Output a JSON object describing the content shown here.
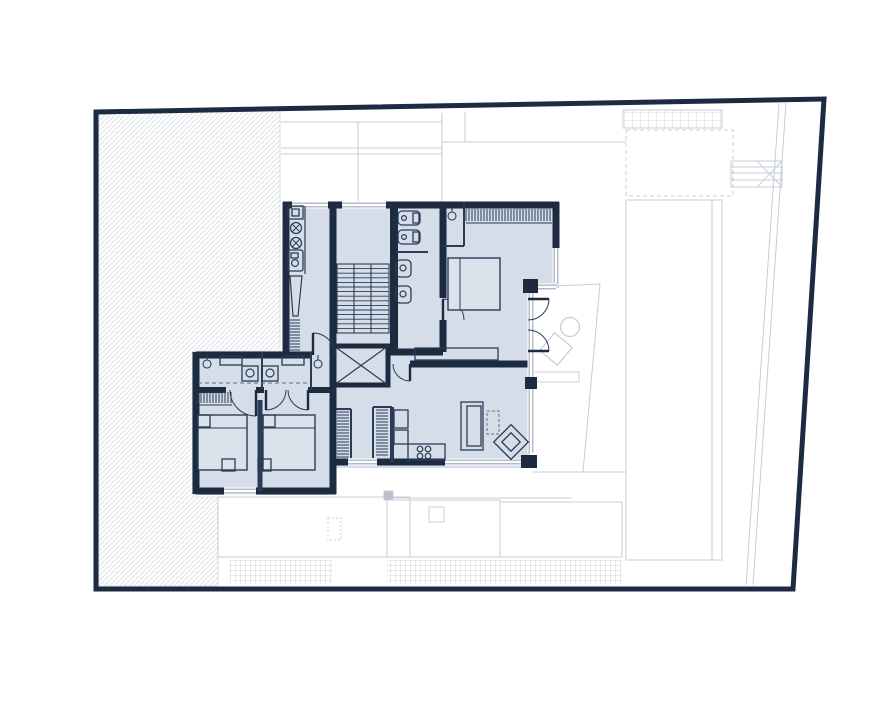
{
  "meta": {
    "description": "architectural-floor-plan",
    "canvas": {
      "width": 891,
      "height": 713,
      "background": "#ffffff"
    }
  },
  "colors": {
    "navy": "#1c2b40",
    "room_fill": "#d5dee8",
    "bed_fill": "#dae2eb",
    "thin": "#2b3b57",
    "window": "#9aa6b6",
    "site": "#c7ccd5",
    "hatch": "#dcdfe4",
    "dash": "#5f6e84",
    "white": "#ffffff",
    "post": "#b9c0cb"
  },
  "boundary": {
    "points": [
      [
        96,
        112
      ],
      [
        824,
        99
      ],
      [
        793,
        589
      ],
      [
        96,
        589
      ]
    ],
    "stroke_width": 5
  },
  "hatch_area": {
    "points": [
      [
        99,
        114
      ],
      [
        280,
        109
      ],
      [
        280,
        351
      ],
      [
        196,
        351
      ],
      [
        196,
        497
      ],
      [
        218,
        497
      ],
      [
        218,
        586
      ],
      [
        99,
        586
      ]
    ],
    "line_spacing": 5
  },
  "site": {
    "lines": [
      [
        281,
        122,
        442,
        122
      ],
      [
        281,
        148,
        442,
        148
      ],
      [
        281,
        154,
        442,
        154
      ],
      [
        358,
        122,
        358,
        202
      ],
      [
        442,
        113,
        442,
        202
      ],
      [
        465,
        112,
        465,
        142
      ],
      [
        442,
        142,
        626,
        142
      ],
      [
        533,
        287,
        600,
        284
      ],
      [
        600,
        284,
        583,
        472
      ],
      [
        533,
        472,
        626,
        472
      ],
      [
        387,
        498,
        572,
        498
      ],
      [
        410,
        497,
        410,
        557
      ],
      [
        712,
        200,
        712,
        560
      ],
      [
        731,
        167,
        782,
        167
      ],
      [
        731,
        173,
        782,
        173
      ],
      [
        731,
        180,
        782,
        180
      ],
      [
        757,
        161,
        782,
        187
      ],
      [
        757,
        187,
        782,
        161
      ],
      [
        779,
        103,
        746,
        585
      ],
      [
        786,
        103,
        753,
        585
      ]
    ],
    "rects": [
      {
        "name": "terrace-south-west",
        "x": 218,
        "y": 497,
        "w": 192,
        "h": 60
      },
      {
        "name": "terrace-south-mid",
        "x": 387,
        "y": 500,
        "w": 113,
        "h": 57
      },
      {
        "name": "terrace-skylight",
        "x": 429,
        "y": 507,
        "w": 15,
        "h": 15
      },
      {
        "name": "terrace-south-east",
        "x": 500,
        "y": 502,
        "w": 122,
        "h": 55
      },
      {
        "name": "pool-strip",
        "x": 626,
        "y": 200,
        "w": 96,
        "h": 360
      },
      {
        "name": "roof-dashed",
        "x": 626,
        "y": 130,
        "w": 107,
        "h": 66,
        "dash": "4 3"
      },
      {
        "name": "bridge-box",
        "x": 731,
        "y": 161,
        "w": 51,
        "h": 26
      },
      {
        "name": "terrace-bench",
        "x": 534,
        "y": 372,
        "w": 45,
        "h": 10,
        "fill": "#ffffff"
      },
      {
        "name": "terrace-post",
        "x": 384,
        "y": 491,
        "w": 9,
        "h": 9,
        "fill": "#b9c0cb"
      },
      {
        "name": "chimney-dashed",
        "x": 328,
        "y": 518,
        "w": 13,
        "h": 22,
        "dash": "2 2"
      }
    ],
    "grids": [
      {
        "name": "pergola-grid",
        "x": 623,
        "y": 110,
        "w": 99,
        "h": 18,
        "step": 8,
        "border": true
      },
      {
        "name": "deck-grid-west",
        "x": 230,
        "y": 560,
        "w": 103,
        "h": 24,
        "step": 5,
        "border": false
      },
      {
        "name": "deck-grid-east",
        "x": 387,
        "y": 560,
        "w": 235,
        "h": 24,
        "step": 5,
        "border": false
      }
    ],
    "circles": [
      {
        "name": "terrace-table",
        "cx": 570,
        "cy": 327,
        "r": 9.5
      }
    ],
    "diamonds": [
      {
        "name": "terrace-chair",
        "cx": 556,
        "cy": 349,
        "r": 16
      }
    ]
  },
  "plan": {
    "silhouette": [
      [
        283,
        202
      ],
      [
        559,
        202
      ],
      [
        559,
        288
      ],
      [
        530,
        288
      ],
      [
        530,
        468
      ],
      [
        330,
        468
      ],
      [
        330,
        495
      ],
      [
        192,
        495
      ],
      [
        192,
        351
      ],
      [
        283,
        351
      ]
    ],
    "walls": [
      [
        283,
        205,
        292,
        205,
        7
      ],
      [
        328,
        205,
        342,
        205,
        7
      ],
      [
        386,
        205,
        559,
        205,
        7
      ],
      [
        286,
        202,
        286,
        352,
        7
      ],
      [
        196,
        355,
        312,
        355,
        7
      ],
      [
        196,
        352,
        196,
        494,
        7
      ],
      [
        196,
        491,
        224,
        491,
        7
      ],
      [
        256,
        491,
        336,
        491,
        7
      ],
      [
        333,
        352,
        333,
        494,
        7
      ],
      [
        333,
        462,
        348,
        462,
        7
      ],
      [
        377,
        462,
        445,
        462,
        7
      ],
      [
        410,
        364,
        531,
        364,
        7
      ],
      [
        394,
        202,
        394,
        352,
        8
      ],
      [
        443,
        202,
        443,
        298,
        7
      ],
      [
        443,
        320,
        443,
        352,
        7
      ],
      [
        333,
        202,
        333,
        352,
        7
      ],
      [
        556,
        202,
        556,
        248,
        7
      ],
      [
        390,
        352,
        443,
        352,
        7
      ],
      [
        196,
        390,
        226,
        390,
        6
      ],
      [
        256,
        390,
        264,
        390,
        6
      ],
      [
        308,
        390,
        336,
        390,
        6
      ]
    ],
    "navy_blocks": [
      {
        "name": "glass-step-corner",
        "x": 523,
        "y": 279,
        "w": 15,
        "h": 14
      },
      {
        "name": "glass-mid-pier",
        "x": 525,
        "y": 377,
        "w": 12,
        "h": 12
      },
      {
        "name": "living-south-corner",
        "x": 521,
        "y": 455,
        "w": 16,
        "h": 13
      }
    ],
    "thin_walls": [
      [
        464,
        202,
        464,
        246,
        2
      ],
      [
        443,
        246,
        464,
        246,
        2
      ],
      [
        262,
        352,
        262,
        390,
        2
      ],
      [
        311,
        352,
        311,
        390,
        2
      ],
      [
        396,
        252,
        428,
        252,
        2
      ],
      [
        351,
        409,
        351,
        458,
        2
      ],
      [
        336,
        409,
        351,
        409,
        2
      ],
      [
        373,
        407,
        373,
        458,
        2
      ],
      [
        373,
        407,
        392,
        407,
        2
      ],
      [
        392,
        407,
        392,
        462,
        4
      ],
      [
        260,
        400,
        260,
        491,
        5
      ]
    ],
    "windows": [
      [
        292,
        205,
        328,
        205
      ],
      [
        342,
        205,
        386,
        205
      ],
      [
        556,
        248,
        556,
        283
      ],
      [
        538,
        287,
        556,
        287
      ],
      [
        531,
        293,
        531,
        377
      ],
      [
        531,
        389,
        531,
        453
      ],
      [
        348,
        462,
        377,
        462
      ],
      [
        445,
        462,
        521,
        462
      ],
      [
        224,
        491,
        256,
        491
      ]
    ],
    "doors": [
      {
        "name": "hall-door",
        "cx": 313,
        "cy": 355,
        "r": 22,
        "a1": 270,
        "a2": 0
      },
      {
        "name": "living-door",
        "cx": 410,
        "cy": 364,
        "r": 17,
        "a1": 90,
        "a2": 180
      },
      {
        "name": "ensuite-door",
        "cx": 443,
        "cy": 320,
        "r": 21,
        "a1": 270,
        "a2": 0
      },
      {
        "name": "terrace-door-a",
        "cx": 528,
        "cy": 299,
        "r": 21,
        "a1": 0,
        "a2": 90
      },
      {
        "name": "terrace-door-b",
        "cx": 528,
        "cy": 351,
        "r": 21,
        "a1": 0,
        "a2": 270
      },
      {
        "name": "bedroom2-door",
        "cx": 256,
        "cy": 390,
        "r": 26,
        "a1": 90,
        "a2": 180
      },
      {
        "name": "bedroom3-door-a",
        "cx": 266,
        "cy": 390,
        "r": 20,
        "a1": 90,
        "a2": 0
      },
      {
        "name": "bedroom3-door-b",
        "cx": 308,
        "cy": 390,
        "r": 20,
        "a1": 90,
        "a2": 180
      }
    ],
    "stairs": {
      "x": 337,
      "y": 264,
      "w": 52,
      "h": 69,
      "treads": 15,
      "stringers": [
        354,
        371
      ]
    },
    "elevator": {
      "x": 334,
      "y": 346,
      "w": 54,
      "h": 39
    },
    "furniture": [
      {
        "name": "kitchen-counter-edge",
        "type": "line",
        "x1": 305,
        "y1": 206,
        "x2": 305,
        "y2": 274,
        "w": 1.2
      },
      {
        "name": "kitchen-cabinet",
        "type": "rect",
        "x": 288,
        "y": 206,
        "w": 15,
        "h": 13
      },
      {
        "name": "kitchen-cabinet-knob",
        "type": "rect",
        "x": 292,
        "y": 209,
        "w": 7,
        "h": 7
      },
      {
        "name": "hob-burner-1",
        "type": "burner",
        "cx": 296,
        "cy": 228,
        "r": 5.5
      },
      {
        "name": "hob-burner-2",
        "type": "burner",
        "cx": 296,
        "cy": 243,
        "r": 5.5
      },
      {
        "name": "kitchen-sink",
        "type": "rect",
        "x": 288,
        "y": 250,
        "w": 15,
        "h": 21,
        "rx": 2
      },
      {
        "name": "kitchen-sink-basin",
        "type": "circle",
        "cx": 295,
        "cy": 263,
        "r": 3.4
      },
      {
        "name": "kitchen-sink-top",
        "type": "rect",
        "x": 291,
        "y": 253,
        "w": 7,
        "h": 5
      },
      {
        "name": "drying-rack",
        "type": "poly",
        "pts": [
          [
            290,
            276
          ],
          [
            302,
            276
          ],
          [
            298,
            316
          ],
          [
            293,
            316
          ]
        ]
      },
      {
        "name": "kitchen-radiator",
        "type": "comb",
        "x": 288,
        "y": 320,
        "len": 32,
        "dir": "v",
        "tick": 12,
        "sp": 3
      },
      {
        "name": "wc-1",
        "type": "rect",
        "x": 398,
        "y": 211,
        "w": 22,
        "h": 14,
        "rx": 4
      },
      {
        "name": "wc-1-tank",
        "type": "rect",
        "x": 413,
        "y": 213,
        "w": 6,
        "h": 10
      },
      {
        "name": "wc-1-drain",
        "type": "circle",
        "cx": 404,
        "cy": 218,
        "r": 2.4
      },
      {
        "name": "wc-2",
        "type": "rect",
        "x": 398,
        "y": 230,
        "w": 22,
        "h": 14,
        "rx": 4
      },
      {
        "name": "wc-2-tank",
        "type": "rect",
        "x": 413,
        "y": 232,
        "w": 6,
        "h": 10
      },
      {
        "name": "wc-2-drain",
        "type": "circle",
        "cx": 404,
        "cy": 237,
        "r": 2.4
      },
      {
        "name": "basin-1",
        "type": "rect",
        "x": 396,
        "y": 260,
        "w": 15,
        "h": 17,
        "rx": 4
      },
      {
        "name": "basin-1-drain",
        "type": "circle",
        "cx": 403,
        "cy": 268,
        "r": 3
      },
      {
        "name": "basin-2",
        "type": "rect",
        "x": 396,
        "y": 286,
        "w": 15,
        "h": 17,
        "rx": 4
      },
      {
        "name": "basin-2-drain",
        "type": "circle",
        "cx": 403,
        "cy": 294,
        "r": 3
      },
      {
        "name": "wardrobe-1",
        "type": "comb",
        "x": 466,
        "y": 209,
        "len": 86,
        "dir": "h",
        "tick": 12,
        "sp": 3,
        "rail": true
      },
      {
        "name": "ceiling-lamp-1",
        "type": "lamp",
        "cx": 452,
        "cy": 216
      },
      {
        "name": "bed-1",
        "type": "bed",
        "x": 448,
        "y": 258,
        "w": 52,
        "h": 52,
        "head": "left"
      },
      {
        "name": "sideboard",
        "type": "rect",
        "x": 415,
        "y": 348,
        "w": 83,
        "h": 12
      },
      {
        "name": "ceiling-lamp-2",
        "type": "lamp",
        "cx": 207,
        "cy": 364
      },
      {
        "name": "ceiling-lamp-3",
        "type": "lamp",
        "cx": 318,
        "cy": 364
      },
      {
        "name": "bath-cabinet-1",
        "type": "rect",
        "x": 220,
        "y": 356,
        "w": 22,
        "h": 9
      },
      {
        "name": "bath-cabinet-2",
        "type": "rect",
        "x": 282,
        "y": 356,
        "w": 22,
        "h": 9
      },
      {
        "name": "washer-1",
        "type": "rect",
        "x": 242,
        "y": 366,
        "w": 16,
        "h": 15
      },
      {
        "name": "washer-1-door",
        "type": "circle",
        "cx": 250,
        "cy": 373,
        "r": 4
      },
      {
        "name": "washer-2",
        "type": "rect",
        "x": 262,
        "y": 366,
        "w": 16,
        "h": 15
      },
      {
        "name": "washer-2-door",
        "type": "circle",
        "cx": 270,
        "cy": 373,
        "r": 4
      },
      {
        "name": "shower-screen",
        "type": "line",
        "x1": 198,
        "y1": 383,
        "x2": 308,
        "y2": 383,
        "w": 1,
        "dash": "4 3"
      },
      {
        "name": "wardrobe-2",
        "type": "comb",
        "x": 198,
        "y": 392,
        "len": 34,
        "dir": "h",
        "tick": 11,
        "sp": 3,
        "rail": true
      },
      {
        "name": "bed-2",
        "type": "bed",
        "x": 198,
        "y": 415,
        "w": 49,
        "h": 55,
        "head": "top"
      },
      {
        "name": "bed-2-table-a",
        "type": "rect",
        "x": 198,
        "y": 415,
        "w": 12,
        "h": 12
      },
      {
        "name": "bed-2-table-b",
        "type": "rect",
        "x": 222,
        "y": 459,
        "w": 13,
        "h": 12
      },
      {
        "name": "bed-3",
        "type": "bed",
        "x": 263,
        "y": 415,
        "w": 52,
        "h": 55,
        "head": "top"
      },
      {
        "name": "bed-3-table-a",
        "type": "rect",
        "x": 263,
        "y": 415,
        "w": 12,
        "h": 12
      },
      {
        "name": "bed-3-table-b",
        "type": "rect",
        "x": 258,
        "y": 459,
        "w": 13,
        "h": 12
      },
      {
        "name": "closet-comb-1",
        "type": "comb",
        "x": 337,
        "y": 412,
        "len": 46,
        "dir": "v",
        "tick": 12,
        "sp": 3
      },
      {
        "name": "closet-comb-2",
        "type": "comb",
        "x": 376,
        "y": 410,
        "len": 47,
        "dir": "v",
        "tick": 12,
        "sp": 3
      },
      {
        "name": "kitchenette-counter",
        "type": "rect",
        "x": 394,
        "y": 410,
        "w": 14,
        "h": 18
      },
      {
        "name": "kitchenette-sink",
        "type": "rect",
        "x": 394,
        "y": 430,
        "w": 14,
        "h": 14
      },
      {
        "name": "kitchenette-bar",
        "type": "rect",
        "x": 408,
        "y": 444,
        "w": 37,
        "h": 16
      },
      {
        "name": "stool-1",
        "type": "circle",
        "cx": 420,
        "cy": 449,
        "r": 2.8
      },
      {
        "name": "stool-2",
        "type": "circle",
        "cx": 428,
        "cy": 449,
        "r": 2.8
      },
      {
        "name": "stool-3",
        "type": "circle",
        "cx": 420,
        "cy": 456,
        "r": 2.8
      },
      {
        "name": "stool-4",
        "type": "circle",
        "cx": 428,
        "cy": 456,
        "r": 2.8
      },
      {
        "name": "sofa",
        "type": "rect",
        "x": 461,
        "y": 402,
        "w": 22,
        "h": 48
      },
      {
        "name": "sofa-seat",
        "type": "rect",
        "x": 467,
        "y": 406,
        "w": 14,
        "h": 40
      },
      {
        "name": "rug",
        "type": "rect",
        "x": 487,
        "y": 411,
        "w": 12,
        "h": 23,
        "dash": "3 2"
      },
      {
        "name": "armchair",
        "type": "diamond",
        "cx": 511,
        "cy": 442,
        "r": 17,
        "r2": 9
      }
    ]
  }
}
